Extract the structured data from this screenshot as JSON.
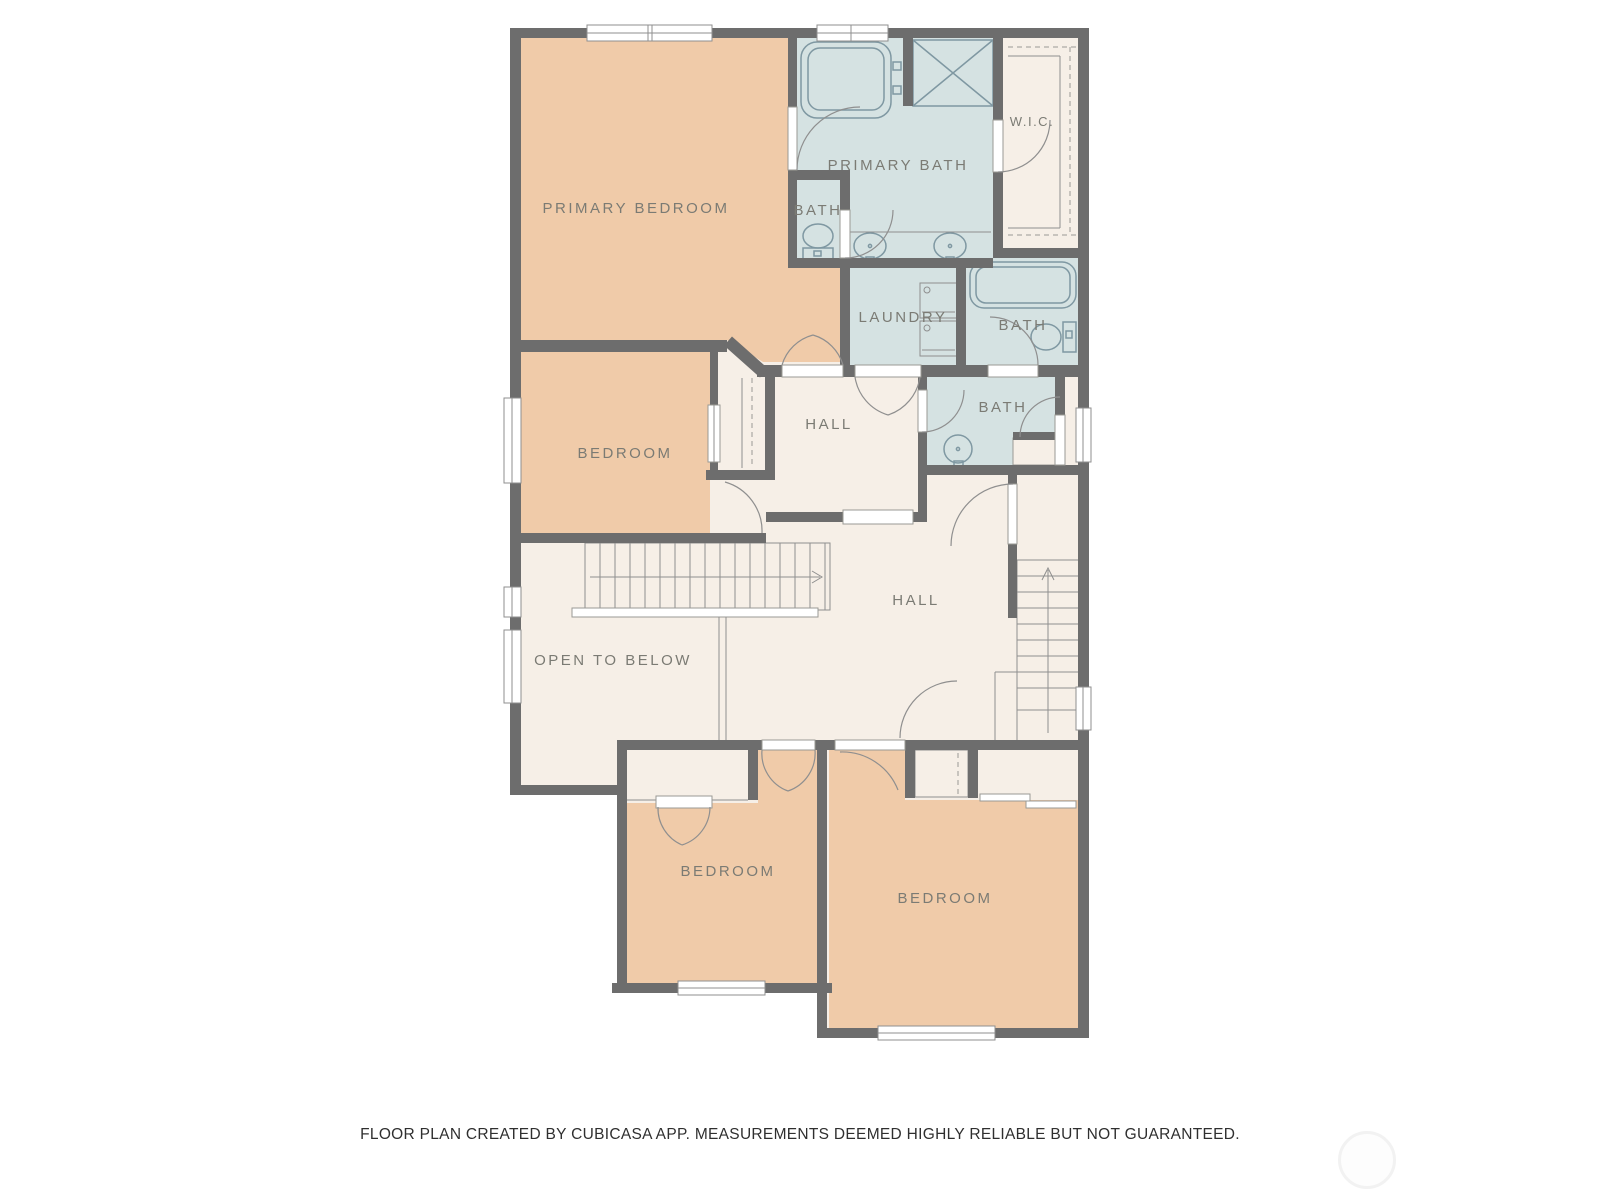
{
  "palette": {
    "wall": "#6d6d6d",
    "bedroom_fill": "#f0cba9",
    "bath_fill": "#d5e2e2",
    "hall_fill": "#f6efe7",
    "fixture_line": "#7f98a2",
    "detail_line": "#8f8f8f",
    "label_color": "#7b7b74",
    "window_fill": "#ffffff",
    "background": "#ffffff"
  },
  "rooms": [
    {
      "id": "primary-bedroom",
      "label": "PRIMARY BEDROOM"
    },
    {
      "id": "primary-bath",
      "label": "PRIMARY BATH"
    },
    {
      "id": "bath-upper-small",
      "label": "BATH"
    },
    {
      "id": "wic",
      "label": "W.I.C."
    },
    {
      "id": "laundry",
      "label": "LAUNDRY"
    },
    {
      "id": "bath-upper-right",
      "label": "BATH"
    },
    {
      "id": "bath-middle",
      "label": "BATH"
    },
    {
      "id": "hall-upper",
      "label": "HALL"
    },
    {
      "id": "bedroom-middle",
      "label": "BEDROOM"
    },
    {
      "id": "hall-main",
      "label": "HALL"
    },
    {
      "id": "open-to-below",
      "label": "OPEN TO BELOW"
    },
    {
      "id": "bedroom-lower-left",
      "label": "BEDROOM"
    },
    {
      "id": "bedroom-lower-right",
      "label": "BEDROOM"
    }
  ],
  "fixtures": [
    "bathtub-icon",
    "shower-icon",
    "toilet-icon",
    "sink-icon",
    "washer-dryer-icon",
    "staircase-icon",
    "window",
    "door-arc",
    "closet-shelf-dashed"
  ],
  "footer": {
    "disclaimer": "FLOOR PLAN CREATED BY CUBICASA APP. MEASUREMENTS DEEMED HIGHLY RELIABLE BUT NOT GUARANTEED."
  }
}
